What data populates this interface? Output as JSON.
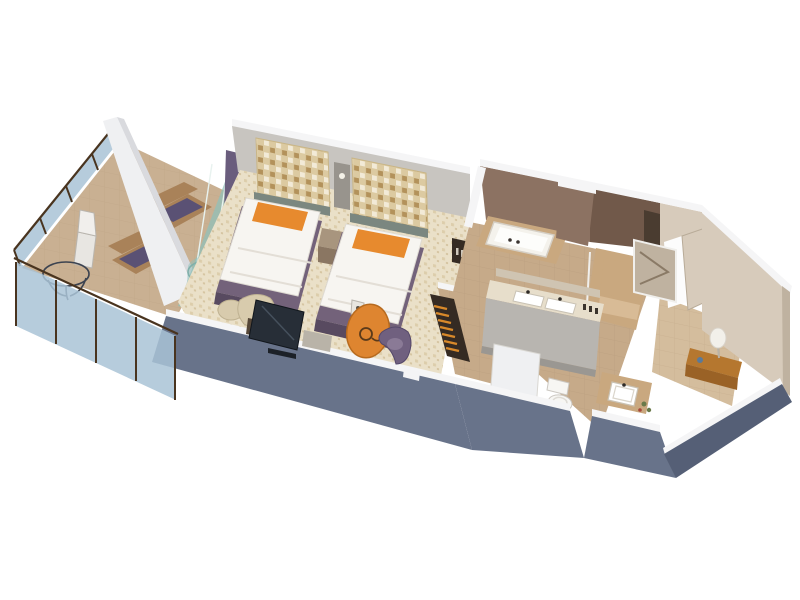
{
  "meta": {
    "title": "3D isometric floor plan rendering of a hotel suite with balcony, twin bedroom, bathroom and entry hall",
    "view": "isometric cutaway, white background, no visible text"
  },
  "rooms": [
    {
      "id": "balcony",
      "label": "Balcony",
      "furniture": [
        "glass railing with dark timber frame",
        "two wicker lounge chairs with purple cushions",
        "round glass table",
        "white side chair"
      ]
    },
    {
      "id": "bedroom",
      "label": "Twin bedroom",
      "furniture": [
        "two twin beds with white duvets and orange pillows",
        "mosaic headboard panels",
        "nightstand with wall lamp",
        "flat-screen TV on console",
        "cream armchair with ottoman",
        "orange oval table with coffee machine",
        "purple tub chair",
        "glass sliding door with purple curtain",
        "round glass enclosure"
      ]
    },
    {
      "id": "wardrobe-hall",
      "label": "Wardrobe hallway",
      "furniture": [
        "open closet with orange hangers",
        "shelf niche with bottles"
      ]
    },
    {
      "id": "bathroom",
      "label": "Bathroom",
      "furniture": [
        "built-in bathtub",
        "double vanity with two sinks",
        "walk-in shower",
        "storage niche"
      ]
    },
    {
      "id": "toilet-room",
      "label": "Toilet room",
      "furniture": [
        "toilet",
        "square-basin vanity",
        "plants"
      ]
    },
    {
      "id": "entry",
      "label": "Entry hall",
      "furniture": [
        "open entry door",
        "mirror panel",
        "wooden console with white table lamp"
      ]
    }
  ],
  "palette": {
    "bg": "#ffffff",
    "wall_white": "#eff0f2",
    "wall_white_shade": "#d9dade",
    "wall_gray_inner": "#c8c5c0",
    "trim_white": "#f5f5f6",
    "wall_slate": "#68738a",
    "wall_slate_dark": "#555f76",
    "wall_cream": "#d7cbbb",
    "wall_cream_dark": "#bfb2a0",
    "wall_brown": "#8c7262",
    "wall_brown_dark": "#71594a",
    "tile_floor": "#c6aa89",
    "tile_warm": "#c9a87f",
    "carpet": "#eae0c8",
    "balcony_floor": "#c9b092",
    "glass_blue": "#a9c3d6",
    "glass_teal": "#8fc0ba",
    "frame_brown": "#49341f",
    "curtain_purple": "#6a5d7d",
    "duvet_white": "#f7f5f1",
    "pillow_orange": "#e78a2e",
    "bed_base": "#73627a",
    "bed_base_dark": "#584a60",
    "mosaic_base": "#dccaa1",
    "nightstand": "#8a7662",
    "nightstand_top": "#a8957e",
    "tv_screen": "#272e37",
    "tv_stand": "#564738",
    "armchair_cream": "#d8cbad",
    "table_orange": "#de8530",
    "chair_purple": "#70607f",
    "wicker": "#a98259",
    "cushion_purple": "#5a5174",
    "tub_white": "#f4f2ec",
    "vanity_front": "#b8b5b0",
    "counter_cream": "#e7decb",
    "toilet_white": "#f7f6f3",
    "wood_console": "#b5772f",
    "hanger_orange": "#d8892a",
    "niche_dark": "#352b23",
    "lamp_white": "#f2f0ea",
    "plant_green": "#6a7a4a",
    "headboard_strip": "#7b8780",
    "panel_gray": "#98948d"
  }
}
